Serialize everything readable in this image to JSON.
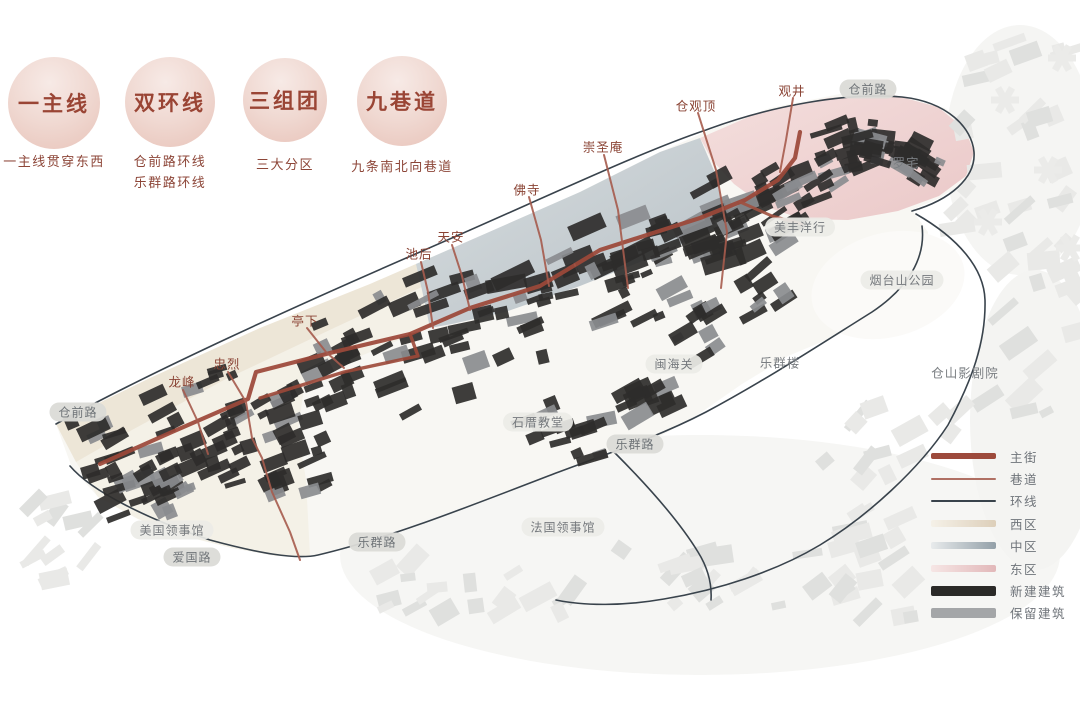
{
  "concepts": [
    {
      "title": "一主线",
      "desc": [
        "一主线贯穿东西"
      ]
    },
    {
      "title": "双环线",
      "desc": [
        "仓前路环线",
        "乐群路环线"
      ]
    },
    {
      "title": "三组团",
      "desc": [
        "三大分区"
      ]
    },
    {
      "title": "九巷道",
      "desc": [
        "九条南北向巷道"
      ]
    }
  ],
  "map": {
    "labels": [
      {
        "text": "龙峰",
        "x": 182,
        "y": 381,
        "type": "alley"
      },
      {
        "text": "忠烈",
        "x": 227,
        "y": 363,
        "type": "alley"
      },
      {
        "text": "亭下",
        "x": 305,
        "y": 320,
        "type": "alley"
      },
      {
        "text": "池后",
        "x": 419,
        "y": 253,
        "type": "alley"
      },
      {
        "text": "天安",
        "x": 451,
        "y": 236,
        "type": "alley"
      },
      {
        "text": "佛寺",
        "x": 527,
        "y": 189,
        "type": "alley"
      },
      {
        "text": "崇圣庵",
        "x": 603,
        "y": 146,
        "type": "alley"
      },
      {
        "text": "仓观顶",
        "x": 696,
        "y": 105,
        "type": "alley"
      },
      {
        "text": "观井",
        "x": 792,
        "y": 90,
        "type": "alley"
      },
      {
        "text": "仓前路",
        "x": 868,
        "y": 89,
        "type": "road"
      },
      {
        "text": "仓前路",
        "x": 78,
        "y": 412,
        "type": "road"
      },
      {
        "text": "乐群路",
        "x": 635,
        "y": 444,
        "type": "road"
      },
      {
        "text": "乐群路",
        "x": 377,
        "y": 542,
        "type": "road"
      },
      {
        "text": "爱国路",
        "x": 192,
        "y": 557,
        "type": "road"
      },
      {
        "text": "美丰洋行",
        "x": 800,
        "y": 227,
        "type": "place"
      },
      {
        "text": "烟台山公园",
        "x": 902,
        "y": 280,
        "type": "place"
      },
      {
        "text": "闽海关",
        "x": 674,
        "y": 364,
        "type": "place"
      },
      {
        "text": "石厝教堂",
        "x": 538,
        "y": 422,
        "type": "place"
      },
      {
        "text": "美国领事馆",
        "x": 172,
        "y": 530,
        "type": "place"
      },
      {
        "text": "法国领事馆",
        "x": 563,
        "y": 527,
        "type": "place"
      },
      {
        "text": "罗宅",
        "x": 906,
        "y": 162,
        "type": "plain"
      },
      {
        "text": "乐群楼",
        "x": 780,
        "y": 362,
        "type": "plain"
      },
      {
        "text": "仓山影剧院",
        "x": 965,
        "y": 372,
        "type": "plain"
      }
    ]
  },
  "legend": {
    "items": [
      {
        "label": "主街",
        "swatch": {
          "kind": "line",
          "color": "#9d4a3c",
          "thickness": 6
        }
      },
      {
        "label": "巷道",
        "swatch": {
          "kind": "line",
          "color": "#b07064",
          "thickness": 2
        }
      },
      {
        "label": "环线",
        "swatch": {
          "kind": "line",
          "color": "#39434c",
          "thickness": 2
        }
      },
      {
        "label": "西区",
        "swatch": {
          "kind": "gradient",
          "from": "#f5f1e8",
          "to": "#ddcfba"
        }
      },
      {
        "label": "中区",
        "swatch": {
          "kind": "gradient",
          "from": "#e8ebec",
          "to": "#93a0a8"
        }
      },
      {
        "label": "东区",
        "swatch": {
          "kind": "gradient",
          "from": "#f6e6e5",
          "to": "#e2b8b9"
        }
      },
      {
        "label": "新建建筑",
        "swatch": {
          "kind": "solid",
          "color": "#2b2a28",
          "thickness": 10
        }
      },
      {
        "label": "保留建筑",
        "swatch": {
          "kind": "solid",
          "color": "#a4a6a8",
          "thickness": 10
        }
      }
    ]
  },
  "colors": {
    "main_street": "#9c4839",
    "alley": "#a65b4d",
    "ring": "#39434c",
    "west_zone": "#e9e0cd",
    "middle_zone": "#bcc5cb",
    "east_zone": "#eed2d2",
    "building_new": "#2e2d2b",
    "building_keep": "#8a8c8f",
    "label_red": "#8a4334",
    "label_gray": "#70757a",
    "circle_text": "#9a4535"
  }
}
